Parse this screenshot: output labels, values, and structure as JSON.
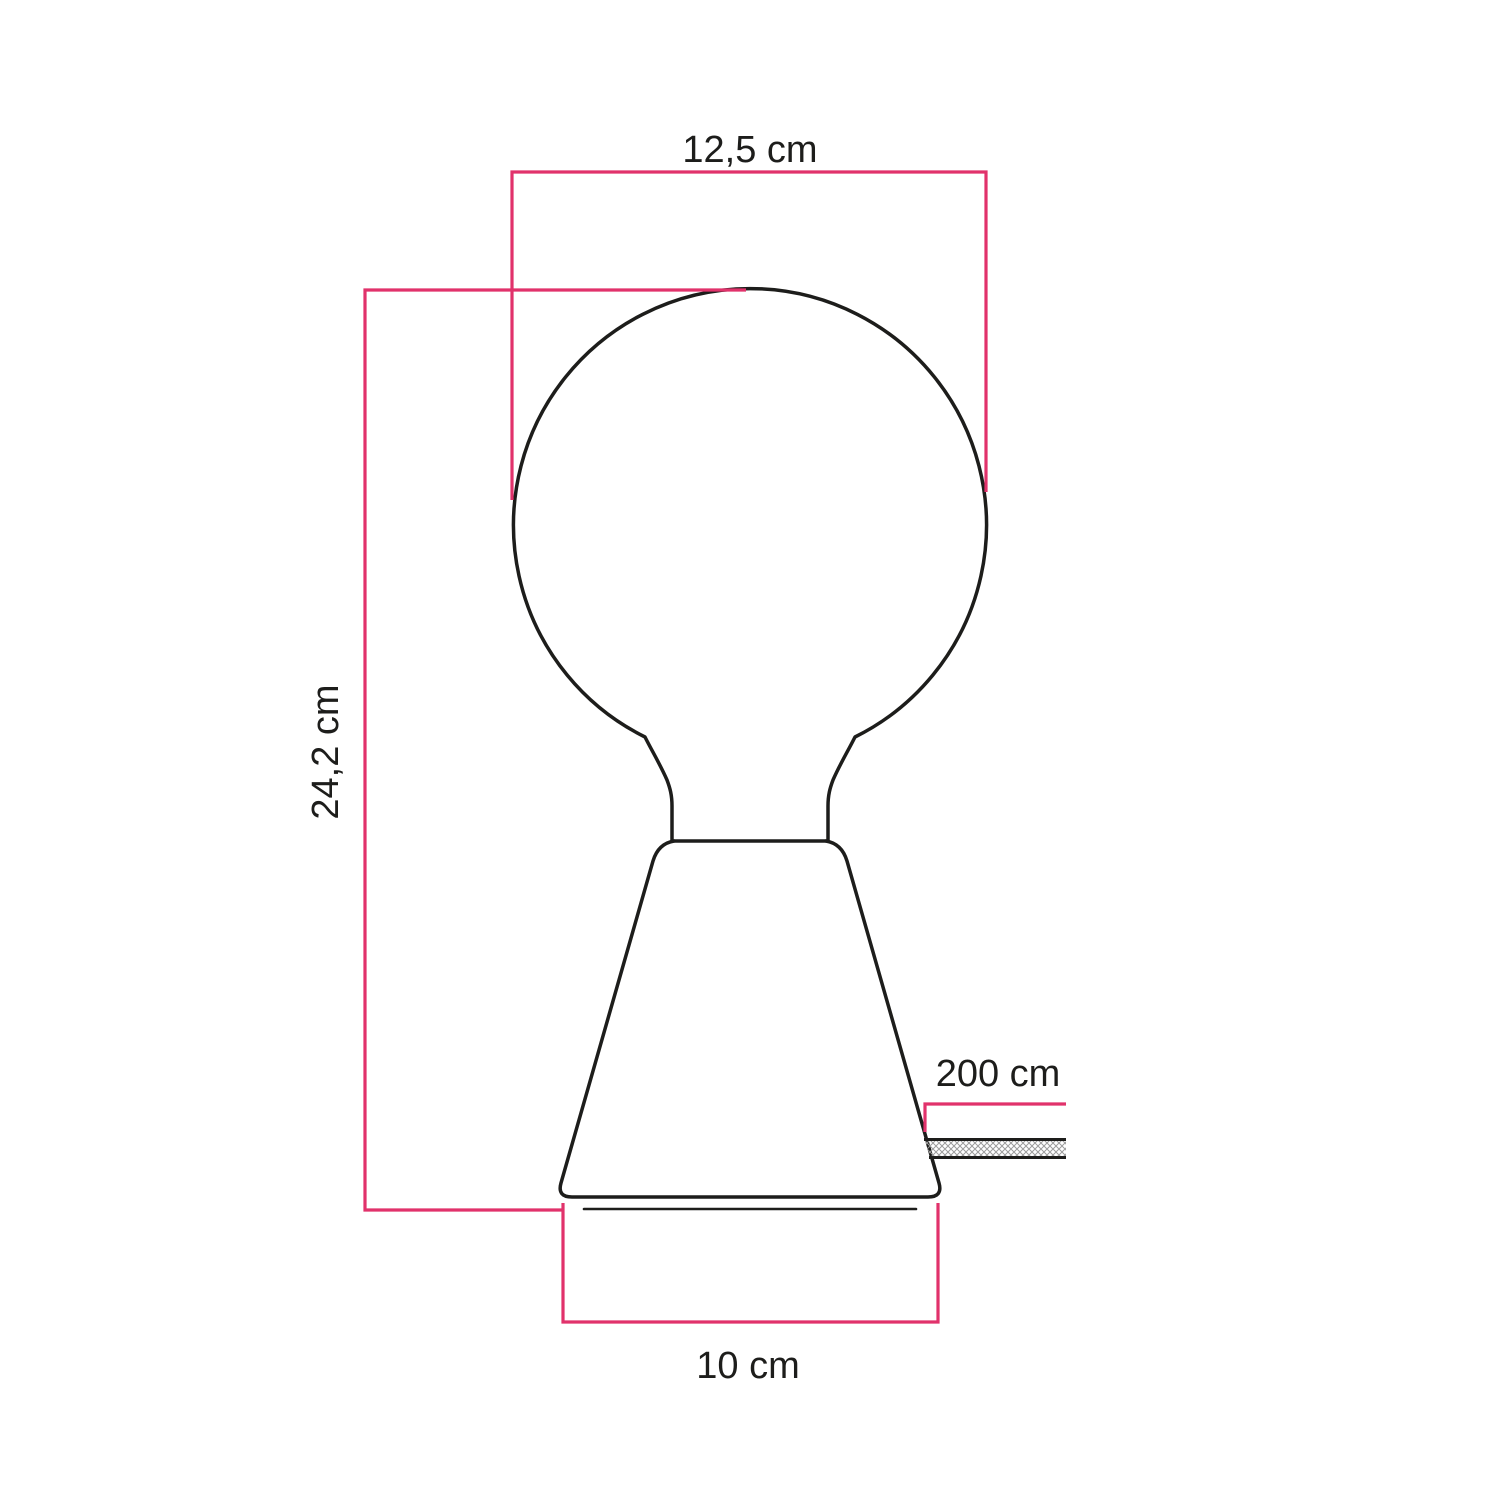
{
  "diagram": {
    "labels": {
      "bulb_diameter": "12,5 cm",
      "total_height": "24,2 cm",
      "cable_length": "200 cm",
      "base_diameter": "10 cm"
    },
    "colors": {
      "dimension_line": "#E1326B",
      "outline": "#1D1D1B",
      "cable_hatch": "#9C9C9C",
      "background": "#FFFFFF"
    }
  }
}
